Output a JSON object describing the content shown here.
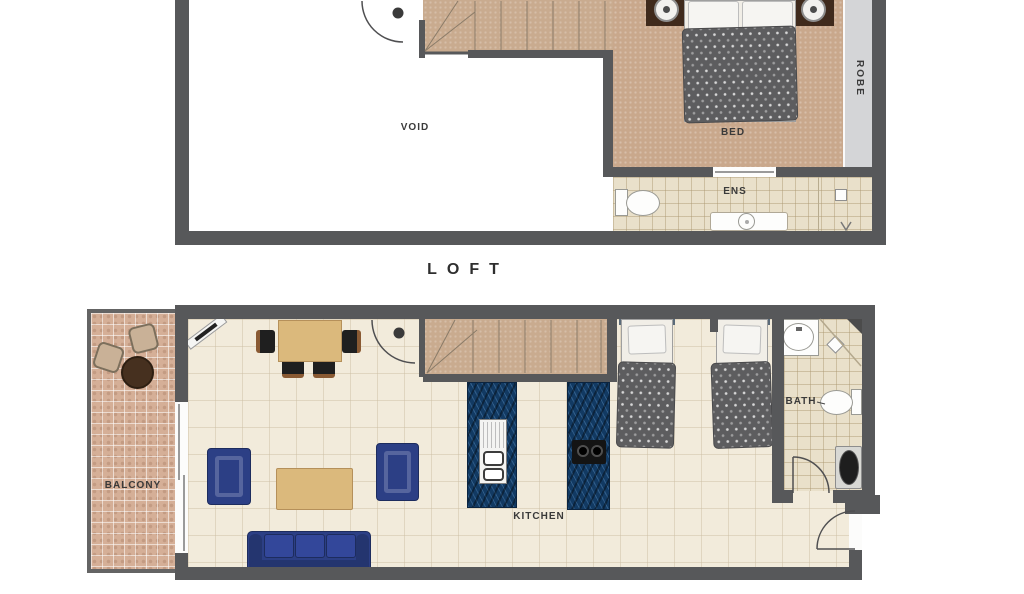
{
  "document_title": "Loft apartment floor plan",
  "colors": {
    "wall": "#57585a",
    "carpet": "#c9a88c",
    "stairs": "#c9ab8f",
    "tile": "#e9e0ca",
    "robe": "#d4d5d7",
    "floor": "#f2ebdb",
    "balcony": "#d5af97",
    "counter": "#123a63",
    "navy": "#2c3f85",
    "wood": "#dbb97c",
    "duvet": "#5d5d5f",
    "label": "#3a3a3a"
  },
  "upper_plan": {
    "caption": "LOFT",
    "labels": {
      "void": "VOID",
      "bed": "BED",
      "robe": "ROBE",
      "ens": "ENS"
    }
  },
  "lower_plan": {
    "labels": {
      "balcony": "BALCONY",
      "kitchen": "KITCHEN",
      "bath": "BATH"
    }
  }
}
